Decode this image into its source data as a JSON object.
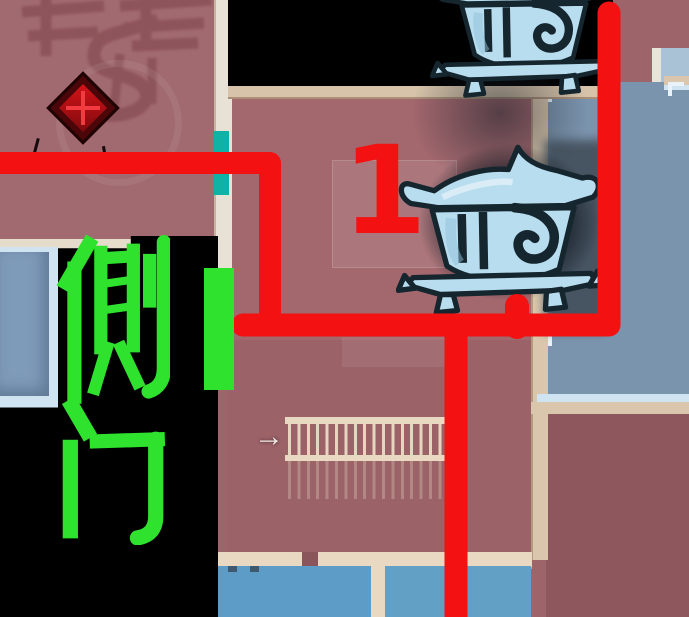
{
  "annotations": {
    "route_number": "1",
    "side_door_label": "侧门",
    "stairs_arrow": "→",
    "watermark_text": "条赛"
  },
  "icons": {
    "chest_top": "treasure-chest-icon",
    "chest_middle": "treasure-chest-icon",
    "danger": "danger-diamond-icon",
    "teal_door": "teal-door-marker",
    "green_door": "side-door-marker",
    "stairs": "staircase",
    "arrow": "stairs-arrow-icon"
  },
  "colors": {
    "route_red": "#f31111",
    "label_green": "#2ee22e",
    "door_teal": "#10b2a5",
    "chest_blue": "#b7ddef",
    "chest_outline": "#15262f",
    "mask_black": "#000000",
    "room_maroon": "#9d646a",
    "room_maroon_tl": "#a16a70",
    "room_maroon_mid": "#a3686e",
    "room_maroon_br": "#8e575d",
    "room_blue": "#7b94ad",
    "room_blue_small": "#7e9bb9",
    "room_blue_bl": "#5c9cc6",
    "room_blue_br2": "#63a0c6",
    "wall_tan": "#d9c6ad",
    "wall_cream": "#ead9c2",
    "wall_light": "#cfe4f0"
  }
}
